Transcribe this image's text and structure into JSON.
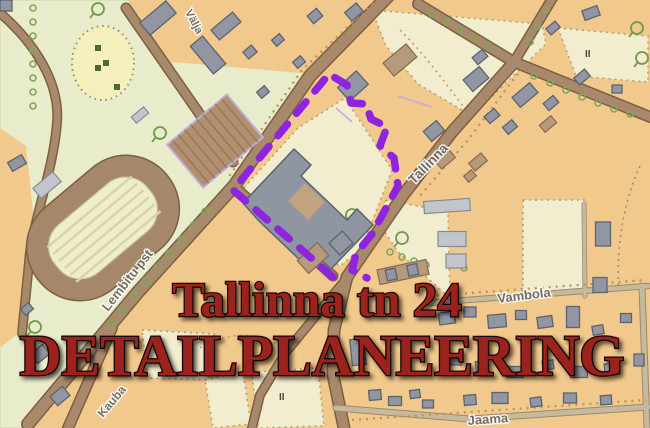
{
  "map": {
    "title": {
      "line1": "Tallinna tn 24",
      "line2": "DETAILPLANEERING",
      "color": "#9c231d"
    },
    "boundary": {
      "color": "#8e24dd",
      "style": "dashed"
    },
    "streets": {
      "valja": "Välja",
      "tallinna": "Tallinna",
      "lembitu": "Lembitu pst",
      "kauba": "Kauba",
      "vambola": "Vambola",
      "jaama": "Jaama"
    },
    "markers": {
      "storeys_label_ne": "II",
      "storeys_label_south": "II"
    },
    "colors": {
      "parcel_orange": "#f2c98c",
      "park_green": "#e9ecca",
      "pale_yellow": "#f3edcf",
      "building_gray": "#9196a2",
      "road_brown": "#a8896b"
    }
  }
}
